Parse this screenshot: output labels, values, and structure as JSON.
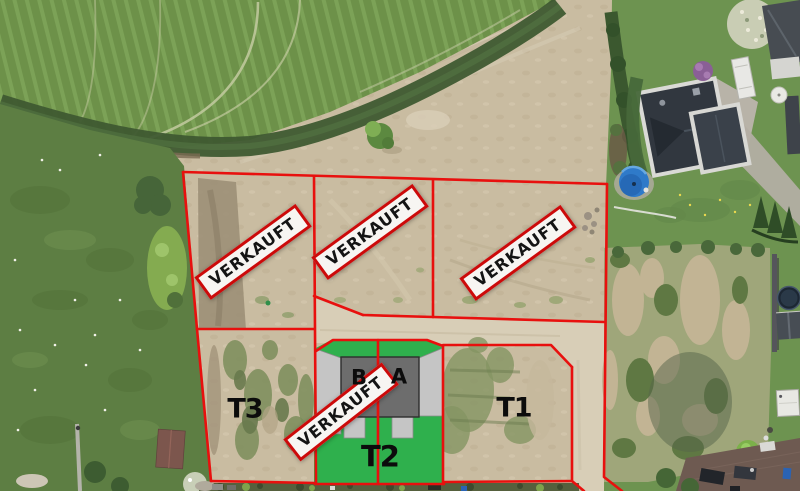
{
  "overlay": {
    "signs": [
      {
        "id": "sold-sign-plot-west",
        "label": "VERKAUFT"
      },
      {
        "id": "sold-sign-plot-middle",
        "label": "VERKAUFT"
      },
      {
        "id": "sold-sign-plot-east",
        "label": "VERKAUFT"
      },
      {
        "id": "sold-sign-unit-b",
        "label": "VERKAUFT"
      }
    ],
    "plots": [
      {
        "id": "plot-t3",
        "label": "T3"
      },
      {
        "id": "plot-t2",
        "label": "T2"
      },
      {
        "id": "plot-t1",
        "label": "T1"
      }
    ],
    "units": [
      {
        "id": "unit-b",
        "label": "B"
      },
      {
        "id": "unit-a",
        "label": "A"
      }
    ],
    "colors": {
      "boundary_red": "#e8100e",
      "sign_background": "#f7f5f2",
      "sign_border": "#cc0a0a",
      "sign_text": "#141414",
      "plot_lawn_green": "#2fb04d",
      "building_gray": "#6d6d6d",
      "paving_gray": "#c5c5c5"
    }
  }
}
